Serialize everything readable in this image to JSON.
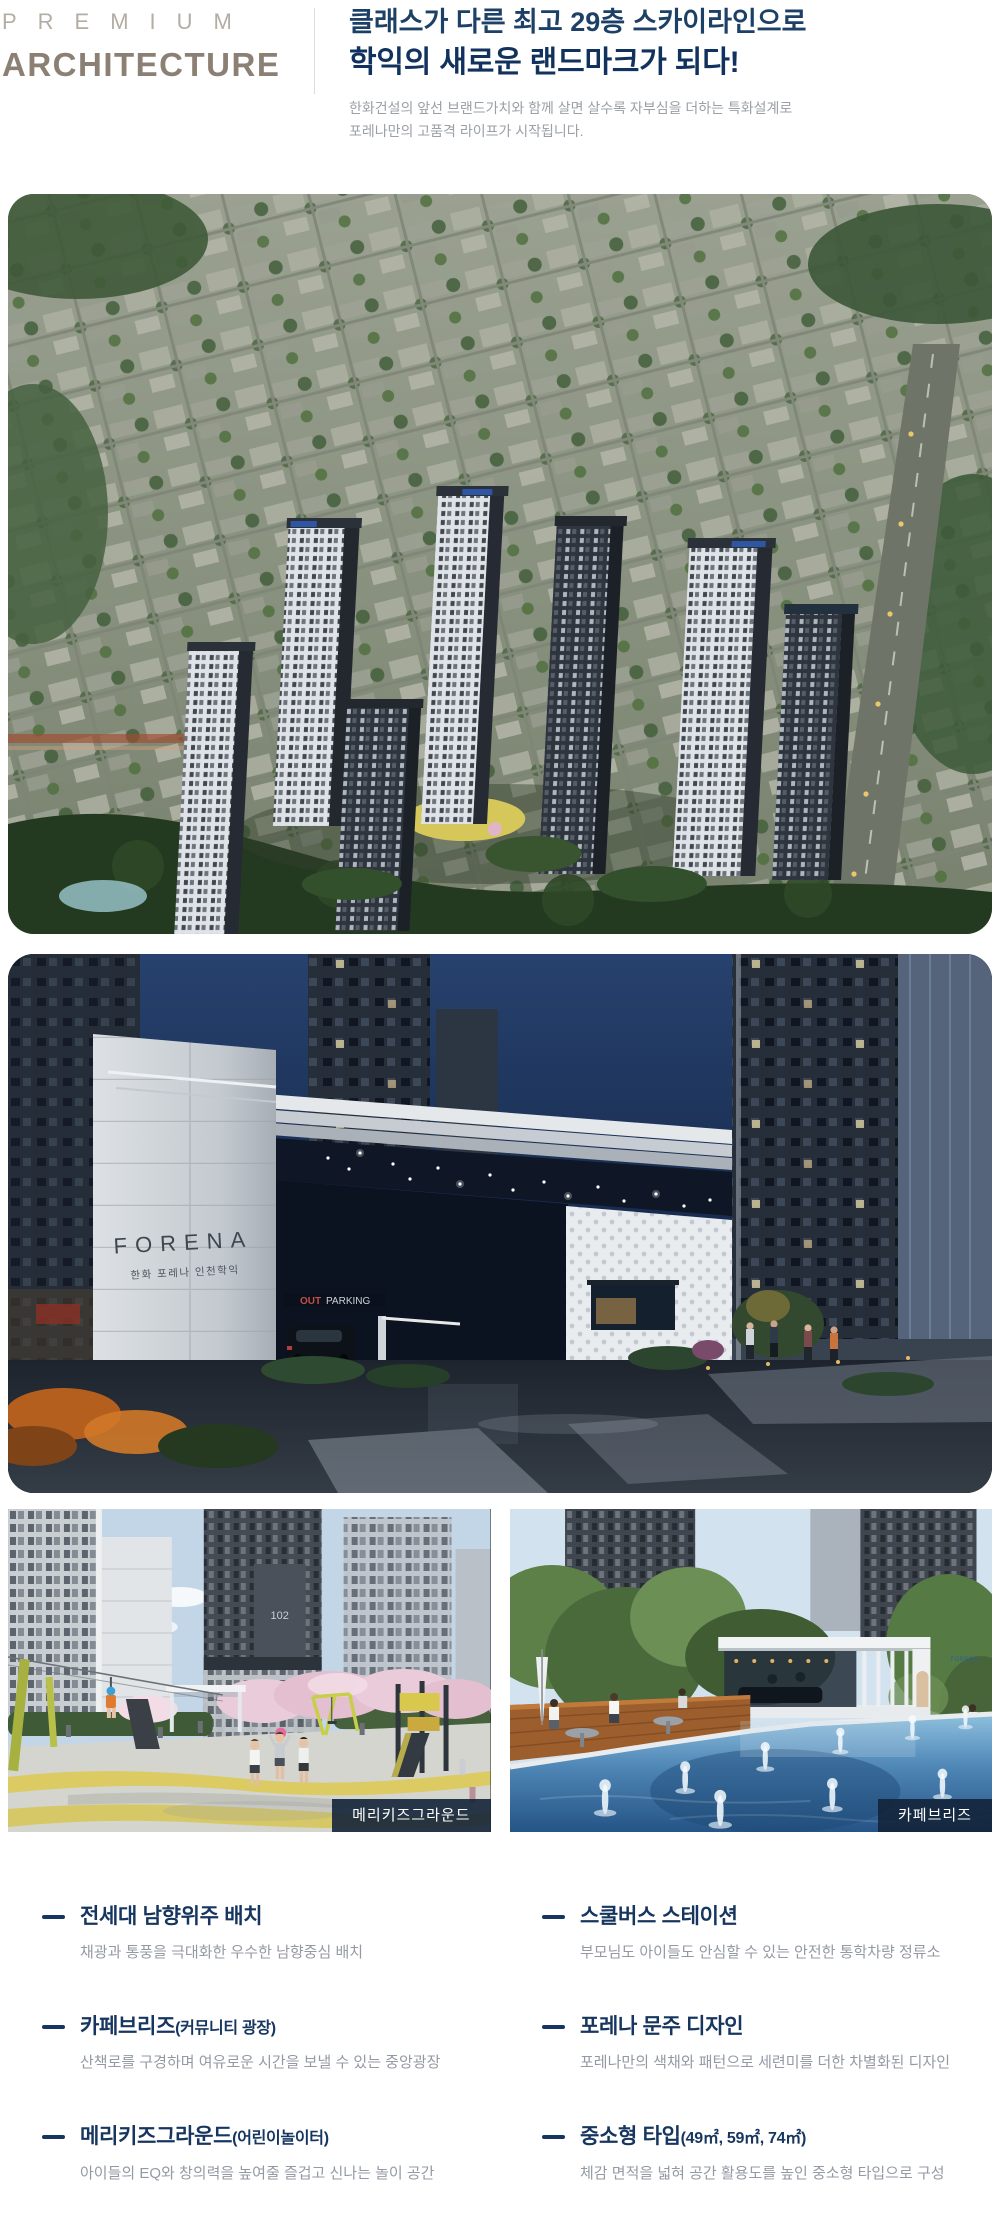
{
  "header": {
    "premium": "PREMIUM",
    "architecture": "ARCHITECTURE",
    "headline1": "클래스가 다른 최고 29층 스카이라인으로",
    "headline2": "학익의 새로운 랜드마크가 되다!",
    "desc1": "한화건설의 앞선 브랜드가치와 함께 살면 살수록 자부심을 더하는 특화설계로",
    "desc2": "포레나만의 고품격 라이프가 시작됩니다.",
    "colors": {
      "premium": "#b3ada4",
      "architecture": "#8b8073",
      "headline": "#1d4066",
      "headline_accent": "#12325e",
      "description": "#9aa0a6",
      "divider": "#dcdcdc"
    }
  },
  "photos": {
    "gate": {
      "sign_brand": "FORENA",
      "sign_sub": "한화 포레나 인천학익",
      "parking_out": "OUT",
      "parking_label": "PARKING"
    },
    "playground": {
      "badge": "메리키즈그라운드",
      "building_number": "102"
    },
    "pool": {
      "badge": "카페브리즈",
      "pavilion_logo": "FORENA"
    }
  },
  "features": {
    "accent_color": "#16365f",
    "left": [
      {
        "title": "전세대 남향위주 배치",
        "paren": "",
        "desc": "채광과 통풍을 극대화한 우수한 남향중심 배치"
      },
      {
        "title": "카페브리즈",
        "paren": "(커뮤니티 광장)",
        "desc": "산책로를 구경하며 여유로운 시간을 보낼 수 있는 중앙광장"
      },
      {
        "title": "메리키즈그라운드",
        "paren": "(어린이놀이터)",
        "desc": "아이들의 EQ와 창의력을 높여줄 즐겁고 신나는 놀이 공간"
      }
    ],
    "right": [
      {
        "title": "스쿨버스 스테이션",
        "paren": "",
        "desc": "부모님도 아이들도 안심할 수 있는 안전한 통학차량 정류소"
      },
      {
        "title": "포레나 문주 디자인",
        "paren": "",
        "desc": "포레나만의 색채와 패턴으로 세련미를 더한 차별화된 디자인"
      },
      {
        "title": "중소형 타입",
        "paren": "(49㎡, 59㎡, 74㎡)",
        "desc": "체감 면적을 넓혀 공간 활용도를 높인 중소형 타입으로 구성"
      }
    ]
  }
}
